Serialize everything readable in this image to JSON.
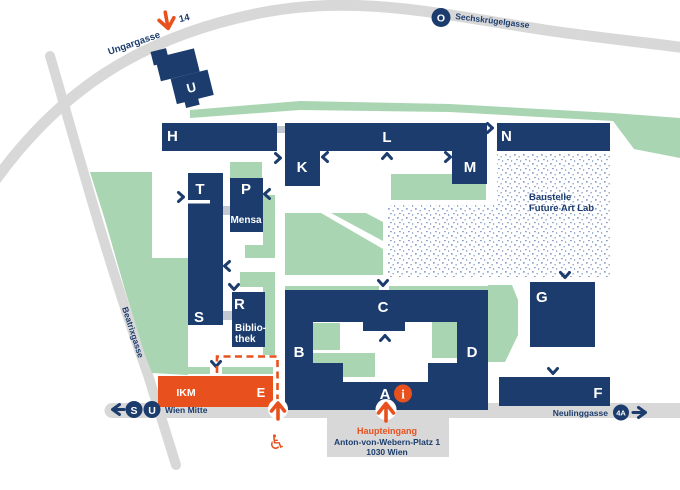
{
  "colors": {
    "navy": "#1b3c6d",
    "green": "#a9d5b2",
    "orange": "#e8511d",
    "road_gray": "#d8d8d8",
    "connector_gray": "#c3c9d3",
    "dot_blue": "#8ba2c9",
    "white": "#ffffff"
  },
  "streets": {
    "ungargasse": "Ungargasse",
    "sechskruegelgasse": "Sechskrügelgasse",
    "beatrixgasse": "Beatrixgasse",
    "neulinggasse": "Neulinggasse"
  },
  "transit": {
    "tram_line_14": "14",
    "tram_line_o": "O",
    "bus_line_4a": "4A",
    "sbahn": "S",
    "ubahn": "U",
    "station_wien_mitte": "Wien Mitte"
  },
  "buildings": {
    "a": "A",
    "b": "B",
    "c": "C",
    "d": "D",
    "e": "E",
    "f": "F",
    "g": "G",
    "h": "H",
    "k": "K",
    "l": "L",
    "m": "M",
    "n": "N",
    "p": "P",
    "r": "R",
    "s": "S",
    "t": "T",
    "u": "U",
    "ikm": "IKM"
  },
  "facilities": {
    "mensa": "Mensa",
    "bibliothek_line1": "Biblio-",
    "bibliothek_line2": "thek",
    "baustelle_line1": "Baustelle",
    "baustelle_line2": "Future Art Lab"
  },
  "main_entrance": {
    "label": "Haupteingang",
    "address_line1": "Anton-von-Webern-Platz 1",
    "address_line2": "1030 Wien",
    "info_symbol": "i",
    "wheelchair_symbol": "♿"
  }
}
